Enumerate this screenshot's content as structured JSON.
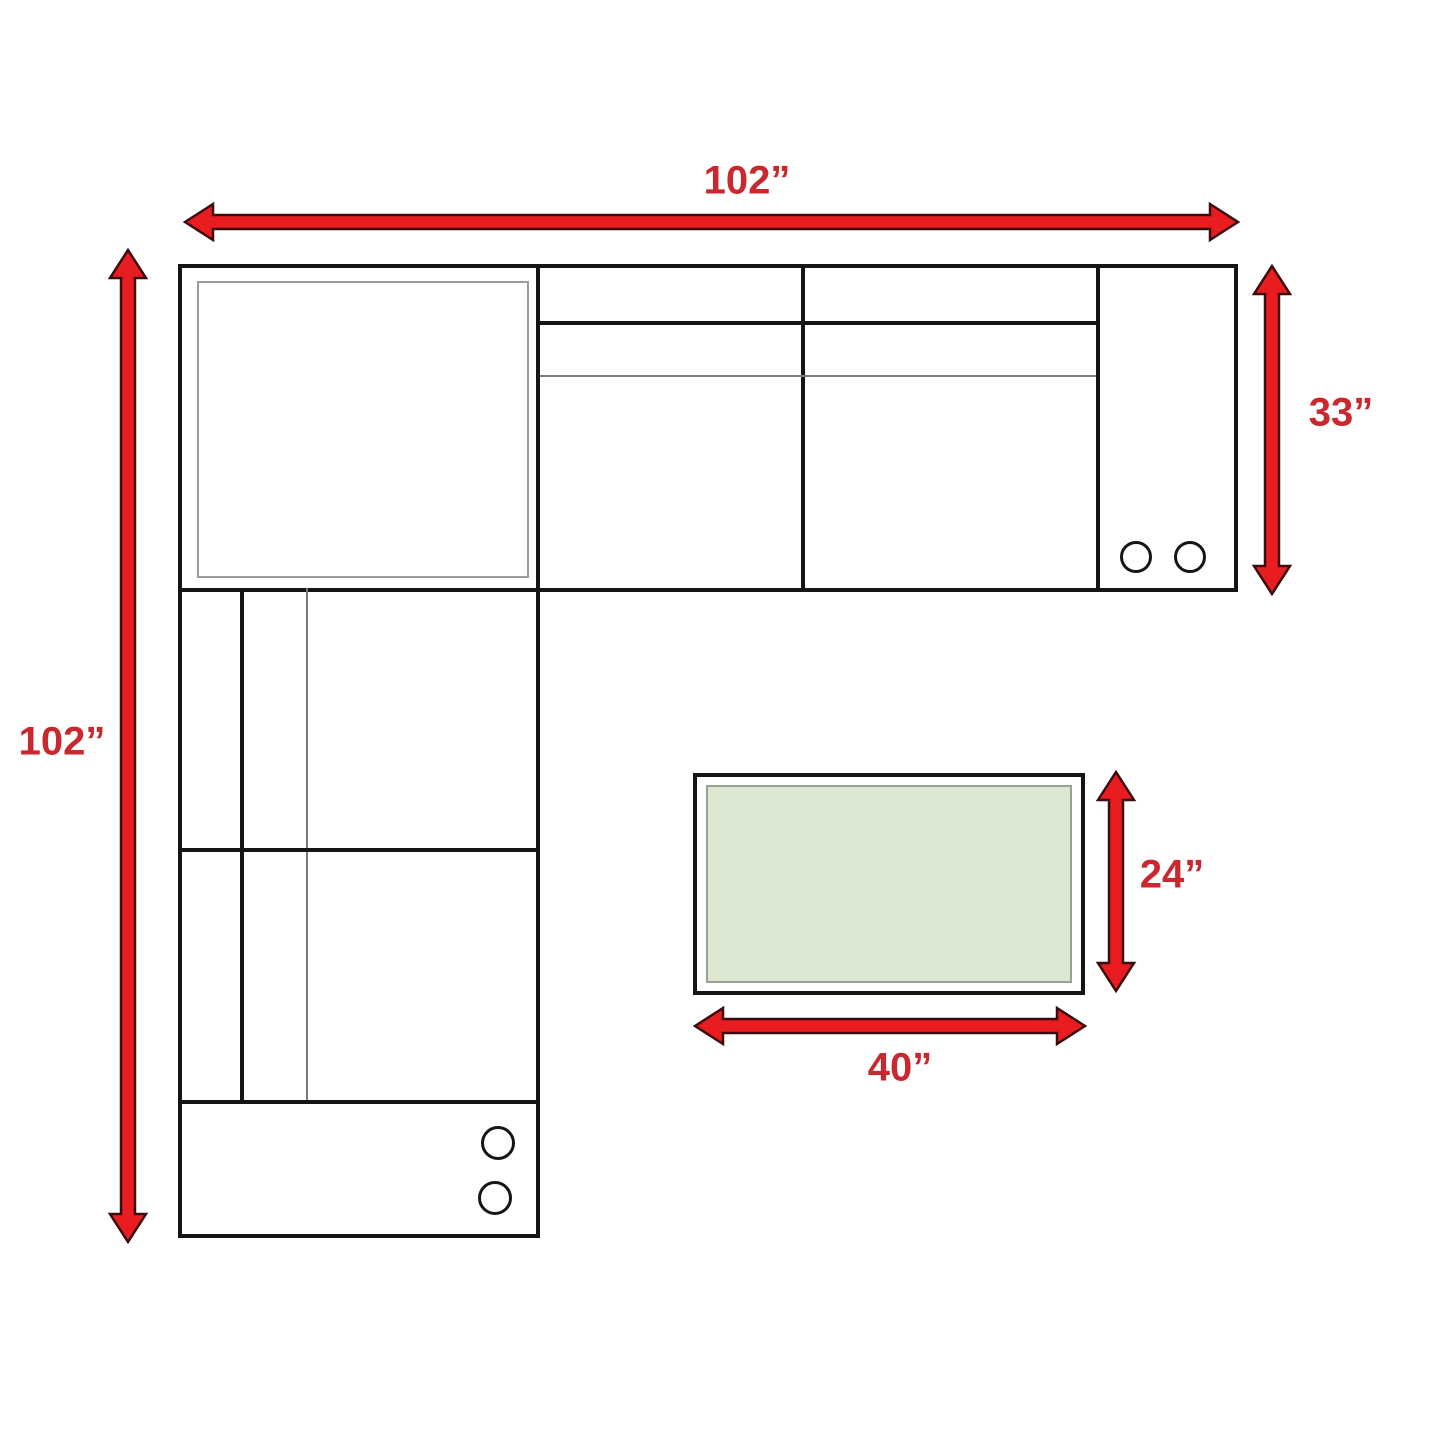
{
  "diagram": {
    "type": "furniture-dimension-plan",
    "labels": {
      "sofa_width_top": "102”",
      "sofa_depth_left": "102”",
      "sofa_section_depth_right": "33”",
      "ottoman_depth": "24”",
      "ottoman_width": "40”"
    },
    "colors": {
      "arrow_fill": "#e91c20",
      "arrow_stroke": "#3a0c0d",
      "label_red": "#c9282e",
      "line_black": "#151515",
      "line_gray": "#7a7a7a",
      "cushion_border": "#9b9b9b",
      "ottoman_green": "#dde8d2",
      "ottoman_border": "#98a292"
    }
  }
}
